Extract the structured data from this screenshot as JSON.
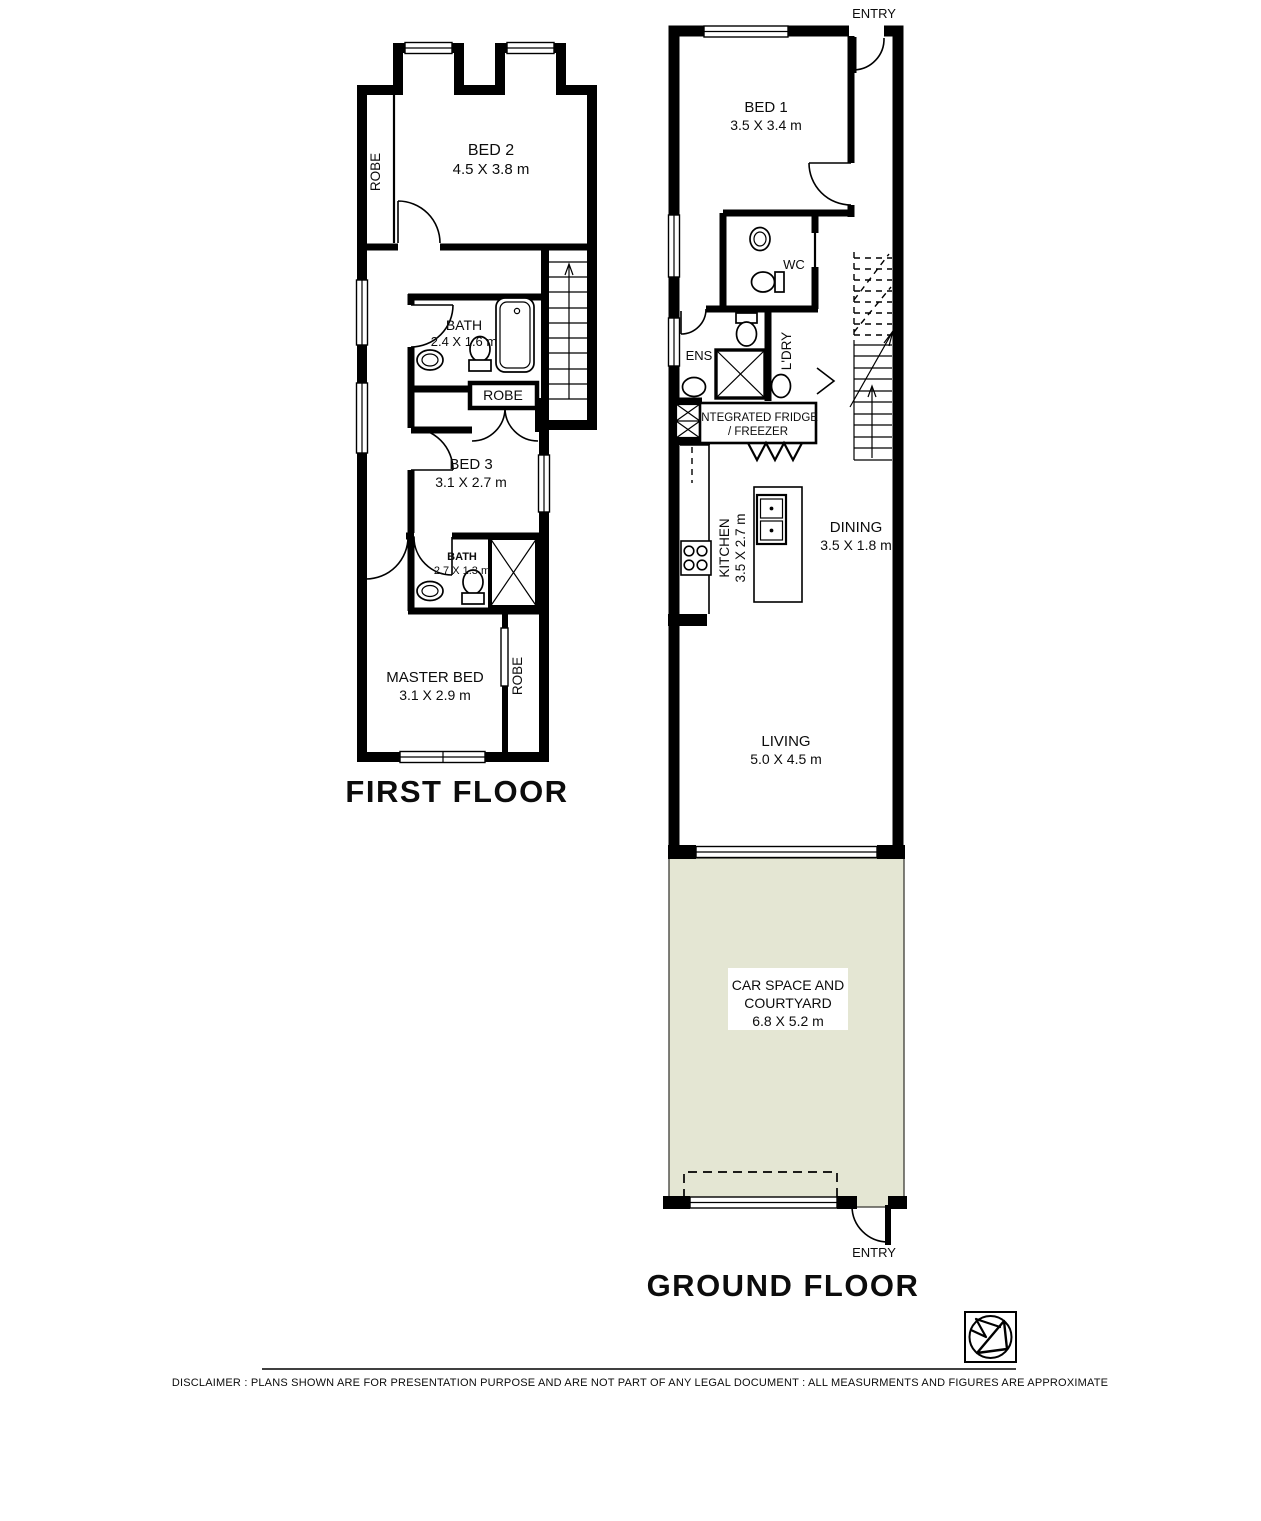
{
  "first_floor": {
    "title": "FIRST FLOOR",
    "rooms": {
      "bed2": {
        "name": "BED 2",
        "dims": "4.5 X 3.8 m"
      },
      "robe_bed2": {
        "name": "ROBE"
      },
      "bath_upper": {
        "name": "BATH",
        "dims": "2.4 X 1.6 m"
      },
      "robe_hall": {
        "name": "ROBE"
      },
      "bed3": {
        "name": "BED 3",
        "dims": "3.1 X 2.7 m"
      },
      "bath_lower": {
        "name": "BATH",
        "dims": "2.7 X 1.3 m"
      },
      "master_bed": {
        "name": "MASTER BED",
        "dims": "3.1 X 2.9 m"
      },
      "robe_master": {
        "name": "ROBE"
      }
    }
  },
  "ground_floor": {
    "title": "GROUND FLOOR",
    "entry_top": "ENTRY",
    "entry_bottom": "ENTRY",
    "rooms": {
      "bed1": {
        "name": "BED 1",
        "dims": "3.5 X 3.4 m"
      },
      "wc": {
        "name": "WC"
      },
      "ens": {
        "name": "ENS"
      },
      "ldry": {
        "name": "L'DRY"
      },
      "fridge": {
        "line1": "INTEGRATED FRIDGE",
        "line2": "/ FREEZER"
      },
      "kitchen": {
        "name": "KITCHEN",
        "dims": "3.5 X 2.7 m"
      },
      "dining": {
        "name": "DINING",
        "dims": "3.5 X 1.8 m"
      },
      "living": {
        "name": "LIVING",
        "dims": "5.0 X 4.5 m"
      },
      "courtyard": {
        "line1": "CAR SPACE AND",
        "line2": "COURTYARD",
        "dims": "6.8 X 5.2 m"
      }
    }
  },
  "footer": {
    "disclaimer": "DISCLAIMER : PLANS SHOWN ARE FOR PRESENTATION PURPOSE AND ARE NOT PART OF ANY LEGAL DOCUMENT : ALL MEASURMENTS AND FIGURES ARE APPROXIMATE"
  },
  "colors": {
    "wall": "#000000",
    "courtyard_fill": "#e4e6d3",
    "background": "#ffffff"
  }
}
